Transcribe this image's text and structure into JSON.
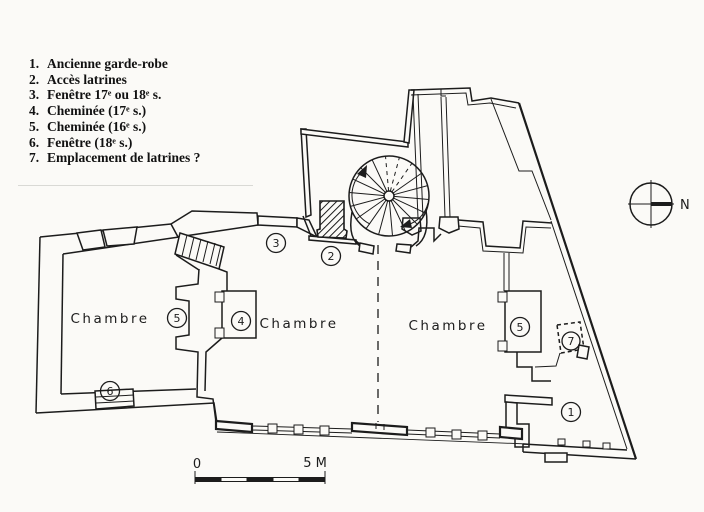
{
  "figure": {
    "type": "architectural-floor-plan",
    "background": "#fbfaf7",
    "ink": "#1c1c1c"
  },
  "legend": {
    "items": [
      {
        "num": "1.",
        "text": "Ancienne garde-robe"
      },
      {
        "num": "2.",
        "text": "Accès latrines"
      },
      {
        "num": "3.",
        "text": "Fenêtre 17ᵉ ou 18ᵉ s."
      },
      {
        "num": "4.",
        "text": "Cheminée (17ᵉ s.)"
      },
      {
        "num": "5.",
        "text": "Cheminée (16ᵉ s.)"
      },
      {
        "num": "6.",
        "text": "Fenêtre (18ᵉ s.)"
      },
      {
        "num": "7.",
        "text": "Emplacement de latrines ?"
      }
    ]
  },
  "plan": {
    "rooms": [
      {
        "label": "Chambre",
        "x": 110,
        "y": 318
      },
      {
        "label": "Chambre",
        "x": 299,
        "y": 323
      },
      {
        "label": "Chambre",
        "x": 448,
        "y": 325
      }
    ],
    "markers": [
      {
        "label": "1",
        "x": 571,
        "y": 412
      },
      {
        "label": "2",
        "x": 331,
        "y": 256
      },
      {
        "label": "3",
        "x": 276,
        "y": 243
      },
      {
        "label": "4",
        "x": 241,
        "y": 321
      },
      {
        "label": "5",
        "x": 177,
        "y": 318
      },
      {
        "label": "5",
        "x": 520,
        "y": 327
      },
      {
        "label": "6",
        "x": 110,
        "y": 391
      },
      {
        "label": "7",
        "x": 571,
        "y": 341
      }
    ],
    "compass": {
      "label": "N"
    },
    "scalebar": {
      "start_label": "0",
      "end_label": "5 M"
    }
  }
}
